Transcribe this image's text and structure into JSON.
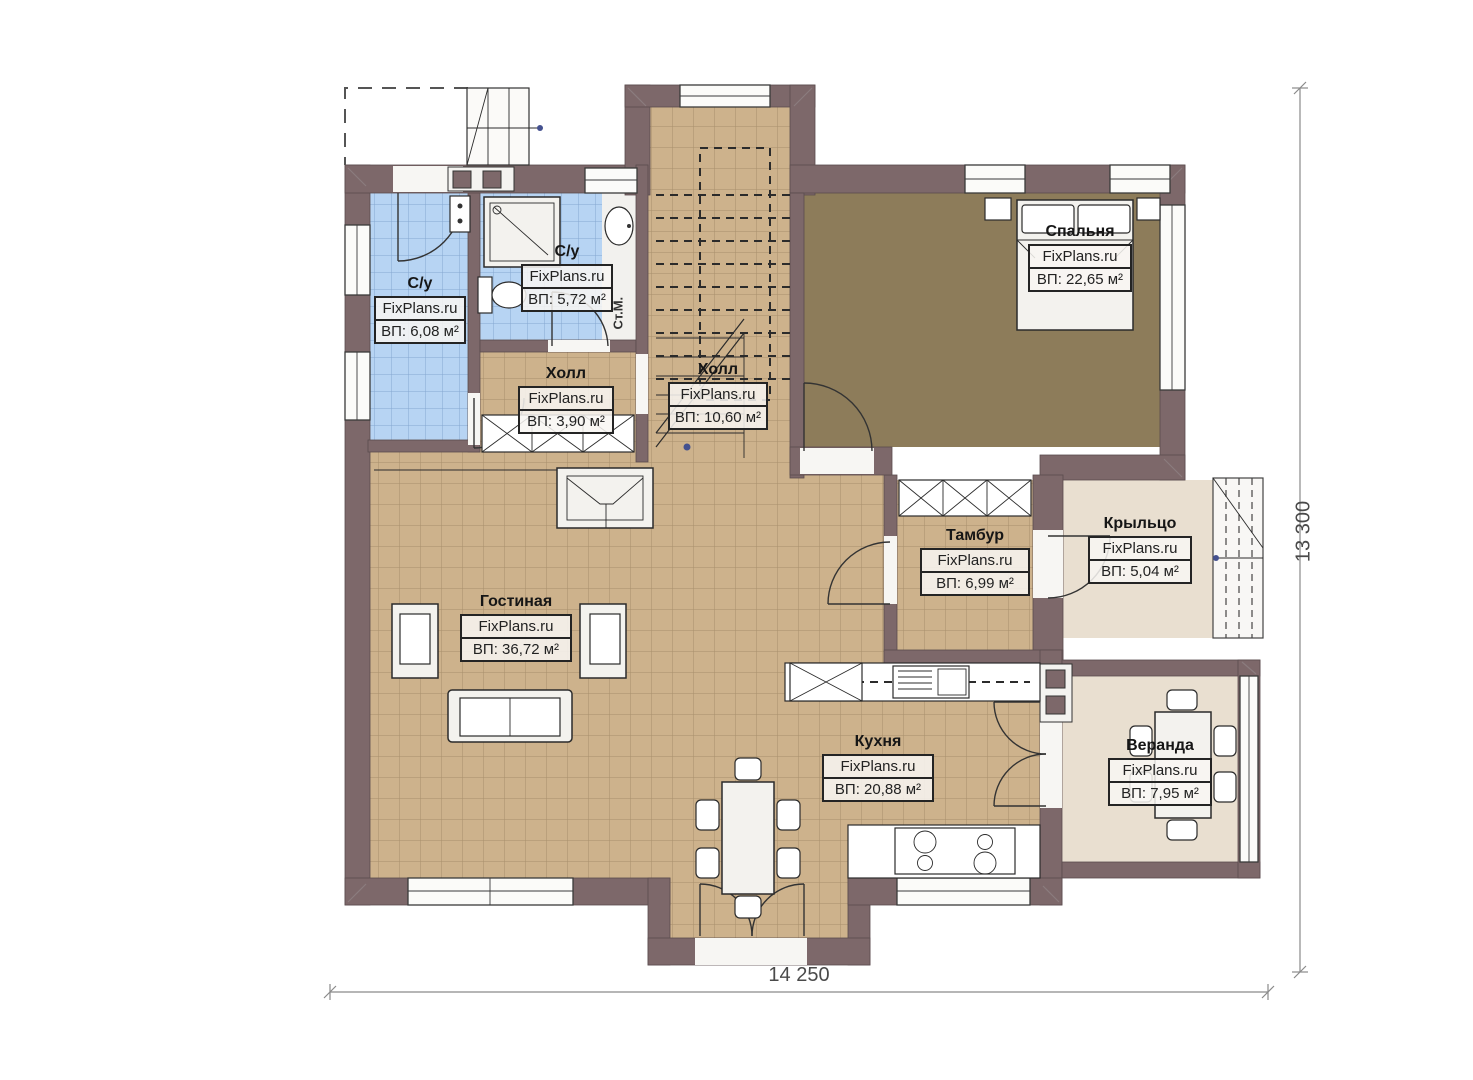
{
  "plan": {
    "watermark": "FixPlans.ru",
    "rooms": [
      {
        "id": "bath-left",
        "name": "С/у",
        "area": "ВП: 6,08 м²"
      },
      {
        "id": "bath-right",
        "name": "С/у",
        "area": "ВП: 5,72 м²"
      },
      {
        "id": "hall-small",
        "name": "Холл",
        "area": "ВП: 3,90 м²"
      },
      {
        "id": "hall-stairs",
        "name": "Холл",
        "area": "ВП: 10,60 м²"
      },
      {
        "id": "bedroom",
        "name": "Спальня",
        "area": "ВП: 22,65 м²"
      },
      {
        "id": "living",
        "name": "Гостиная",
        "area": "ВП: 36,72 м²"
      },
      {
        "id": "tambour",
        "name": "Тамбур",
        "area": "ВП: 6,99 м²"
      },
      {
        "id": "porch",
        "name": "Крыльцо",
        "area": "ВП: 5,04 м²"
      },
      {
        "id": "kitchen",
        "name": "Кухня",
        "area": "ВП: 20,88 м²"
      },
      {
        "id": "veranda",
        "name": "Веранда",
        "area": "ВП: 7,95 м²"
      }
    ],
    "dimensions": {
      "width": "14 250",
      "height": "13 300"
    },
    "labels": {
      "washing_machine": "Ст.М."
    },
    "colors": {
      "wall": "#7d686a",
      "floor_tan": "#cdb28c",
      "floor_blue": "#b7d4f3",
      "floor_bedroom": "#8d7c5a",
      "floor_cream": "#e9dfd0"
    }
  }
}
